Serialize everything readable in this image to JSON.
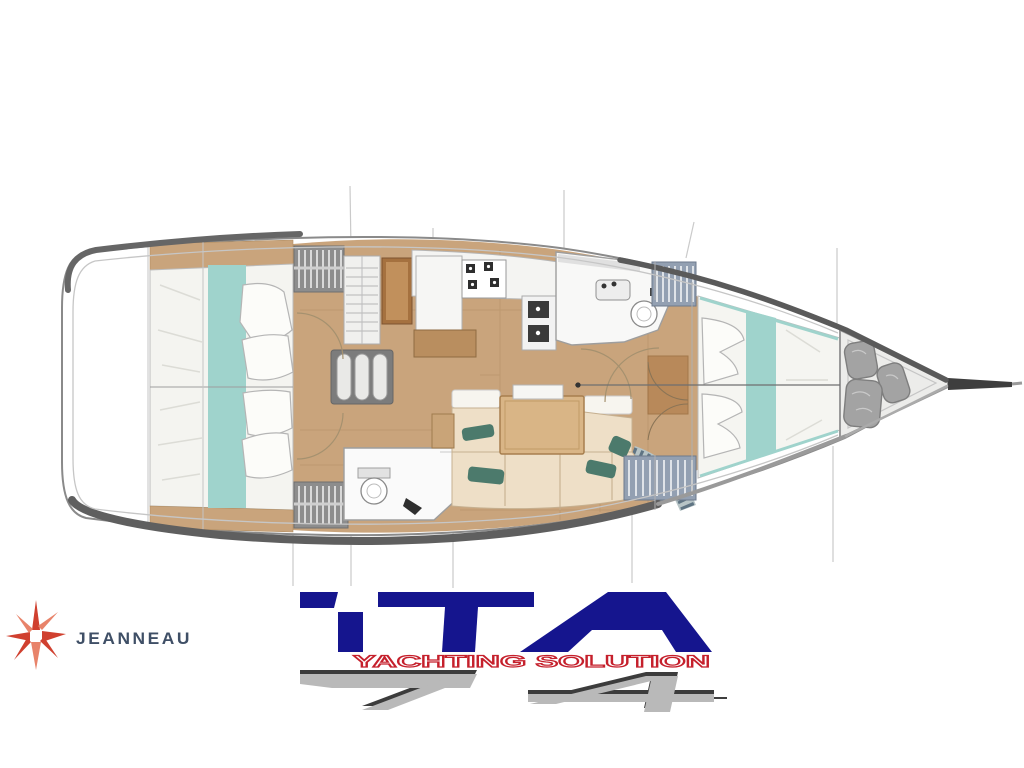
{
  "canvas": {
    "width": 1024,
    "height": 768,
    "background": "#ffffff"
  },
  "plan": {
    "title": "sailing-yacht interior deck plan, bow pointing right",
    "features": [
      "aft-cabin-port",
      "aft-cabin-starboard",
      "companionway-steps",
      "nav-cabinet",
      "chart-table",
      "galley",
      "aft-head",
      "salon-settee",
      "salon-table",
      "forward-head",
      "forward-cabin-v-berth",
      "bow-sail-locker",
      "bowsprit"
    ],
    "colors": {
      "hull_line": "#8a8a8a",
      "hull_shadow": "#5a5a5a",
      "deck_inner_line": "#c6c6c6",
      "floor_wood": "#c9a47c",
      "bed_linen": "#f4f4f0",
      "bed_teal": "#9fd3cc",
      "settee_beige": "#eedfc7",
      "table_wood": "#d9b586",
      "pillow_teal_dark": "#4c7a6c",
      "locker_blue_gray": "#93a0b2",
      "locker_gray": "#8d8d8d",
      "bag_gray": "#a3a3a3"
    }
  },
  "logos": {
    "jeanneau": {
      "name": "JEANNEAU",
      "text_color": "#3f4f66",
      "star_primary": "#d0402f",
      "star_secondary": "#e8836a"
    },
    "ita": {
      "brand": "ITA",
      "tagline": "YACHTING SOLUTION",
      "number": "74",
      "brand_color": "#15158e",
      "tagline_color": "#c5202c",
      "number_fill": "#b9b9b9",
      "number_edge": "#3c3c3c"
    }
  }
}
